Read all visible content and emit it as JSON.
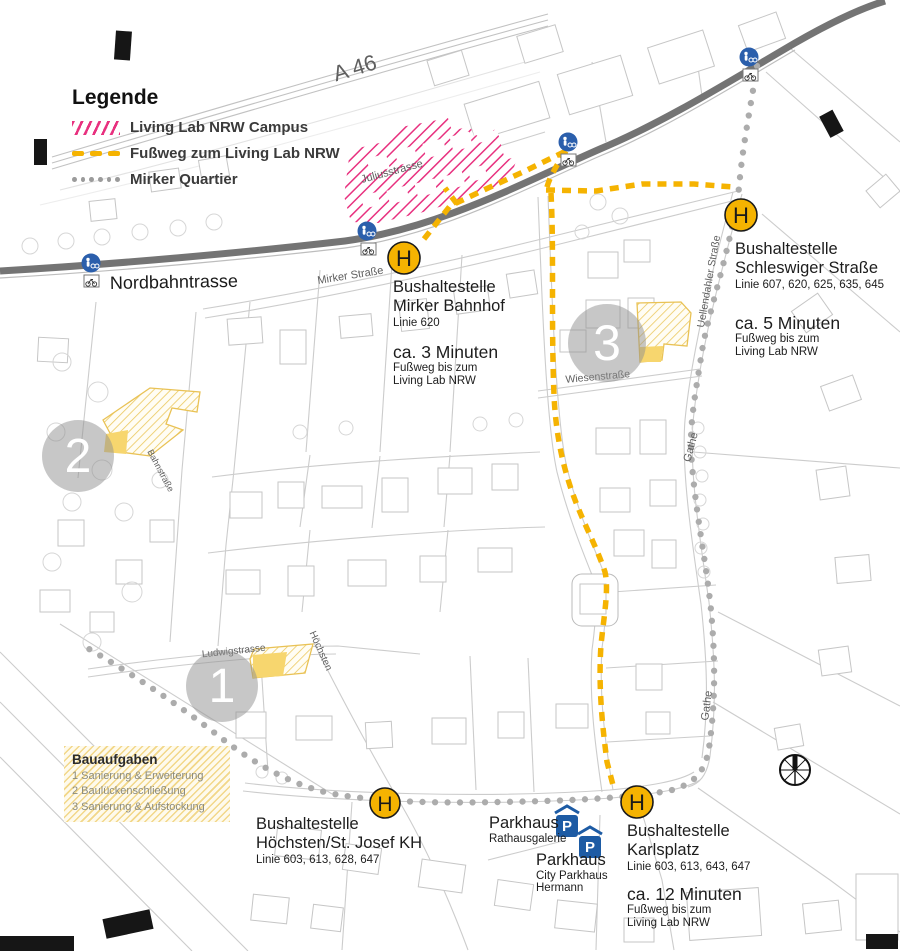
{
  "colors": {
    "accent_yellow": "#F5B301",
    "campus_pink": "#E8317F",
    "quartier_dot_gray": "#ACACAC",
    "trasse_gray": "#747474",
    "sign_blue": "#2B5FAC",
    "parking_blue": "#1D5BA4",
    "site_hatch_yellow": "#EBC85E",
    "site_solid_yellow": "#F7D66E"
  },
  "legend": {
    "title": "Legende",
    "items": [
      {
        "label": "Living Lab NRW Campus",
        "swatch": "pink-hatch"
      },
      {
        "label": "Fußweg zum Living Lab NRW",
        "swatch": "yellow-dash"
      },
      {
        "label": "Mirker Quartier",
        "swatch": "gray-dots"
      }
    ]
  },
  "roads": {
    "a46": "A 46",
    "nordbahntrasse": "Nordbahntrasse",
    "mirker_strasse": "Mirker Straße",
    "juliusstrasse": "Juliusstrasse",
    "wiesenstrasse": "Wiesenstraße",
    "uellendahler_strasse": "Uellendahler Straße",
    "gathe": "Gathe",
    "ludwigstrasse": "Ludwigstrasse",
    "hoechsten": "Höchsten",
    "bahnstrasse": "Bahnstraße"
  },
  "stops": {
    "mirker_bahnhof": {
      "title": "Bushaltestelle",
      "name": "Mirker Bahnhof",
      "lines": "Linie 620",
      "walk_time": "ca. 3 Minuten",
      "walk_sub1": "Fußweg bis zum",
      "walk_sub2": "Living Lab NRW"
    },
    "schleswiger": {
      "title": "Bushaltestelle",
      "name": "Schleswiger Straße",
      "lines": "Linie 607, 620, 625, 635, 645",
      "walk_time": "ca. 5 Minuten",
      "walk_sub1": "Fußweg bis zum",
      "walk_sub2": "Living Lab NRW"
    },
    "hoechsten": {
      "title": "Bushaltestelle",
      "name": "Höchsten/St. Josef KH",
      "lines": "Linie 603, 613, 628, 647"
    },
    "karlsplatz": {
      "title": "Bushaltestelle",
      "name": "Karlsplatz",
      "lines": "Linie 603, 613, 643, 647",
      "walk_time": "ca. 12 Minuten",
      "walk_sub1": "Fußweg bis zum",
      "walk_sub2": "Living Lab NRW"
    }
  },
  "parking": {
    "rathausgalerie": {
      "name": "Parkhaus",
      "sub": "Rathausgalerie"
    },
    "city_parkhaus": {
      "name": "Parkhaus",
      "sub1": "City Parkhaus",
      "sub2": "Hermann"
    }
  },
  "bauaufgaben": {
    "title": "Bauaufgaben",
    "items": [
      "1 Sanierung & Erweiterung",
      "2 Baulückenschließung",
      "3 Sanierung & Aufstockung"
    ]
  },
  "markers": {
    "h_label": "H",
    "p_label": "P",
    "n1": "1",
    "n2": "2",
    "n3": "3"
  }
}
